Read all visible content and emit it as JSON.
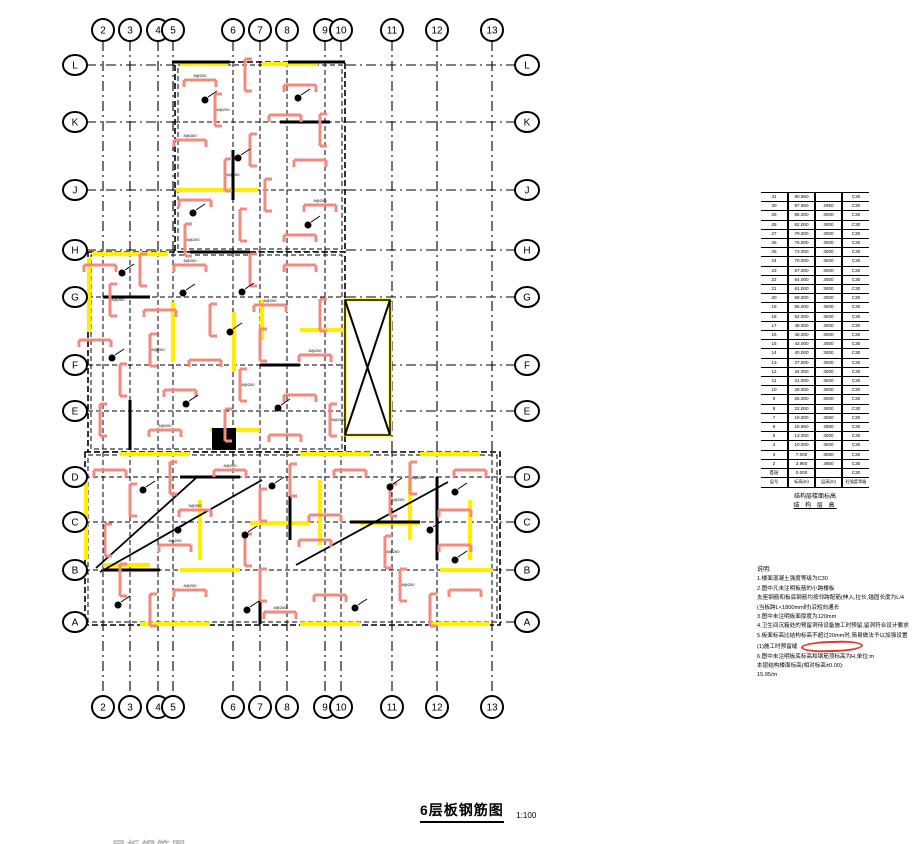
{
  "drawing_title": {
    "text": "6层板钢筋图",
    "scale": "1:100"
  },
  "clipped_next_title": "层板钢筋图",
  "colors": {
    "line": "#000000",
    "rebar": "#f28a80",
    "highlight": "#ffee00",
    "red_mark": "#e23b2e",
    "faint": "#b5b5b5"
  },
  "grid": {
    "cols": [
      {
        "label": "2",
        "x": 103
      },
      {
        "label": "3",
        "x": 130
      },
      {
        "label": "4",
        "x": 158
      },
      {
        "label": "5",
        "x": 173
      },
      {
        "label": "6",
        "x": 233
      },
      {
        "label": "7",
        "x": 260
      },
      {
        "label": "8",
        "x": 287
      },
      {
        "label": "9",
        "x": 325
      },
      {
        "label": "10",
        "x": 341
      },
      {
        "label": "11",
        "x": 392
      },
      {
        "label": "12",
        "x": 437
      },
      {
        "label": "13",
        "x": 492
      }
    ],
    "rows": [
      {
        "label": "L",
        "y": 65
      },
      {
        "label": "K",
        "y": 122
      },
      {
        "label": "J",
        "y": 190
      },
      {
        "label": "H",
        "y": 250
      },
      {
        "label": "G",
        "y": 297
      },
      {
        "label": "F",
        "y": 365
      },
      {
        "label": "E",
        "y": 411
      },
      {
        "label": "D",
        "y": 477
      },
      {
        "label": "C",
        "y": 522
      },
      {
        "label": "B",
        "y": 570
      },
      {
        "label": "A",
        "y": 622
      }
    ],
    "top_bubble_y": 30,
    "bottom_bubble_y": 707,
    "left_bubble_x": 75,
    "right_bubble_x": 527,
    "v_line_y1": 41,
    "v_line_y2": 696,
    "h_line_x1": 86,
    "h_line_x2": 516
  },
  "plan": {
    "blocks": [
      [
        175,
        62,
        345,
        252
      ],
      [
        88,
        252,
        345,
        452
      ],
      [
        85,
        452,
        500,
        625
      ]
    ],
    "void_box": [
      345,
      300,
      390,
      435
    ],
    "solid_block": [
      212,
      428,
      24,
      22
    ],
    "diagonals": [
      [
        100,
        572,
        262,
        480
      ],
      [
        96,
        568,
        196,
        478
      ],
      [
        296,
        565,
        448,
        482
      ]
    ],
    "walls": [
      [
        190,
        252,
        250,
        252
      ],
      [
        280,
        122,
        330,
        122
      ],
      [
        233,
        150,
        233,
        200
      ],
      [
        103,
        297,
        150,
        297
      ],
      [
        260,
        365,
        300,
        365
      ],
      [
        130,
        400,
        130,
        450
      ],
      [
        180,
        477,
        240,
        477
      ],
      [
        350,
        522,
        420,
        522
      ],
      [
        103,
        570,
        160,
        570
      ],
      [
        290,
        477,
        290,
        540
      ],
      [
        437,
        477,
        437,
        560
      ],
      [
        260,
        570,
        260,
        624
      ],
      [
        172,
        62,
        230,
        62
      ],
      [
        288,
        62,
        345,
        62
      ]
    ],
    "yellow_segments": [
      [
        180,
        64,
        228,
        64
      ],
      [
        262,
        64,
        318,
        64
      ],
      [
        92,
        254,
        168,
        254
      ],
      [
        176,
        190,
        258,
        190
      ],
      [
        89,
        258,
        89,
        332
      ],
      [
        173,
        302,
        173,
        362
      ],
      [
        234,
        312,
        234,
        372
      ],
      [
        262,
        300,
        262,
        340
      ],
      [
        300,
        330,
        345,
        330
      ],
      [
        347,
        302,
        389,
        302
      ],
      [
        347,
        434,
        389,
        434
      ],
      [
        346,
        302,
        346,
        434
      ],
      [
        390,
        302,
        390,
        434
      ],
      [
        120,
        454,
        190,
        454
      ],
      [
        300,
        454,
        370,
        454
      ],
      [
        420,
        454,
        480,
        454
      ],
      [
        86,
        480,
        86,
        560
      ],
      [
        200,
        500,
        200,
        560
      ],
      [
        320,
        480,
        320,
        545
      ],
      [
        410,
        478,
        410,
        540
      ],
      [
        470,
        500,
        470,
        560
      ],
      [
        140,
        624,
        210,
        624
      ],
      [
        300,
        624,
        360,
        624
      ],
      [
        430,
        624,
        490,
        624
      ],
      [
        103,
        565,
        150,
        565
      ],
      [
        250,
        523,
        310,
        523
      ],
      [
        360,
        523,
        420,
        523
      ],
      [
        180,
        570,
        240,
        570
      ],
      [
        440,
        570,
        492,
        570
      ],
      [
        210,
        430,
        260,
        430
      ]
    ],
    "rebar_marks": [
      [
        200,
        80,
        "h"
      ],
      [
        245,
        75,
        "v"
      ],
      [
        300,
        85,
        "h"
      ],
      [
        215,
        110,
        "v"
      ],
      [
        285,
        115,
        "h"
      ],
      [
        320,
        130,
        "v"
      ],
      [
        190,
        140,
        "h"
      ],
      [
        250,
        150,
        "v"
      ],
      [
        310,
        160,
        "h"
      ],
      [
        225,
        175,
        "v"
      ],
      [
        195,
        200,
        "h"
      ],
      [
        265,
        195,
        "v"
      ],
      [
        320,
        205,
        "h"
      ],
      [
        240,
        225,
        "v"
      ],
      [
        300,
        235,
        "h"
      ],
      [
        185,
        240,
        "v"
      ],
      [
        100,
        265,
        "h"
      ],
      [
        140,
        270,
        "v"
      ],
      [
        190,
        265,
        "h"
      ],
      [
        250,
        270,
        "v"
      ],
      [
        300,
        265,
        "h"
      ],
      [
        110,
        300,
        "v"
      ],
      [
        160,
        310,
        "h"
      ],
      [
        210,
        320,
        "v"
      ],
      [
        270,
        305,
        "h"
      ],
      [
        320,
        315,
        "v"
      ],
      [
        95,
        340,
        "h"
      ],
      [
        150,
        350,
        "v"
      ],
      [
        205,
        360,
        "h"
      ],
      [
        260,
        345,
        "v"
      ],
      [
        315,
        355,
        "h"
      ],
      [
        120,
        380,
        "v"
      ],
      [
        180,
        390,
        "h"
      ],
      [
        240,
        385,
        "v"
      ],
      [
        300,
        395,
        "h"
      ],
      [
        100,
        420,
        "v"
      ],
      [
        165,
        430,
        "h"
      ],
      [
        225,
        425,
        "v"
      ],
      [
        285,
        435,
        "h"
      ],
      [
        330,
        420,
        "v"
      ],
      [
        110,
        470,
        "h"
      ],
      [
        170,
        478,
        "v"
      ],
      [
        230,
        470,
        "h"
      ],
      [
        290,
        480,
        "v"
      ],
      [
        350,
        470,
        "h"
      ],
      [
        410,
        478,
        "v"
      ],
      [
        470,
        470,
        "h"
      ],
      [
        130,
        500,
        "v"
      ],
      [
        195,
        510,
        "h"
      ],
      [
        260,
        505,
        "v"
      ],
      [
        325,
        515,
        "h"
      ],
      [
        390,
        500,
        "v"
      ],
      [
        455,
        510,
        "h"
      ],
      [
        105,
        540,
        "v"
      ],
      [
        175,
        545,
        "h"
      ],
      [
        245,
        550,
        "v"
      ],
      [
        315,
        540,
        "h"
      ],
      [
        385,
        552,
        "v"
      ],
      [
        455,
        545,
        "h"
      ],
      [
        120,
        580,
        "v"
      ],
      [
        190,
        590,
        "h"
      ],
      [
        260,
        585,
        "v"
      ],
      [
        330,
        595,
        "h"
      ],
      [
        400,
        585,
        "v"
      ],
      [
        465,
        590,
        "h"
      ],
      [
        150,
        610,
        "v"
      ],
      [
        280,
        612,
        "h"
      ],
      [
        430,
        610,
        "v"
      ]
    ],
    "rebar_label": "8@200",
    "dots": [
      [
        205,
        100
      ],
      [
        298,
        98
      ],
      [
        238,
        158
      ],
      [
        193,
        213
      ],
      [
        308,
        225
      ],
      [
        122,
        273
      ],
      [
        183,
        293
      ],
      [
        242,
        292
      ],
      [
        112,
        358
      ],
      [
        230,
        332
      ],
      [
        186,
        404
      ],
      [
        278,
        408
      ],
      [
        143,
        490
      ],
      [
        272,
        486
      ],
      [
        390,
        487
      ],
      [
        455,
        492
      ],
      [
        178,
        530
      ],
      [
        245,
        535
      ],
      [
        430,
        530
      ],
      [
        118,
        605
      ],
      [
        247,
        610
      ],
      [
        355,
        608
      ],
      [
        455,
        560
      ]
    ]
  },
  "elevation_table": {
    "columns": [
      "层号",
      "标高(m)",
      "层高(m)",
      "砼强度等级"
    ],
    "rows": [
      [
        "31",
        "90.950",
        "",
        "C30"
      ],
      [
        "30",
        "87.950",
        "2950",
        "C30"
      ],
      [
        "29",
        "85.000",
        "3000",
        "C30"
      ],
      [
        "28",
        "82.000",
        "3000",
        "C30"
      ],
      [
        "27",
        "79.000",
        "3000",
        "C30"
      ],
      [
        "26",
        "76.000",
        "3000",
        "C30"
      ],
      [
        "25",
        "73.000",
        "3000",
        "C30"
      ],
      [
        "24",
        "70.000",
        "3000",
        "C30"
      ],
      [
        "23",
        "67.000",
        "3000",
        "C30"
      ],
      [
        "22",
        "64.000",
        "3000",
        "C30"
      ],
      [
        "21",
        "61.000",
        "3000",
        "C30"
      ],
      [
        "20",
        "58.000",
        "3000",
        "C30"
      ],
      [
        "19",
        "55.000",
        "3000",
        "C30"
      ],
      [
        "18",
        "52.000",
        "3000",
        "C30"
      ],
      [
        "17",
        "49.000",
        "3000",
        "C30"
      ],
      [
        "16",
        "46.000",
        "3000",
        "C30"
      ],
      [
        "15",
        "43.000",
        "3000",
        "C30"
      ],
      [
        "14",
        "40.000",
        "3000",
        "C30"
      ],
      [
        "13",
        "37.000",
        "3000",
        "C30"
      ],
      [
        "12",
        "34.000",
        "3000",
        "C30"
      ],
      [
        "11",
        "31.000",
        "3000",
        "C30"
      ],
      [
        "10",
        "28.000",
        "3000",
        "C30"
      ],
      [
        "9",
        "25.000",
        "3000",
        "C30"
      ],
      [
        "8",
        "22.000",
        "3000",
        "C30"
      ],
      [
        "7",
        "19.000",
        "3050",
        "C30"
      ],
      [
        "6",
        "15.950",
        "2950",
        "C30"
      ],
      [
        "5",
        "13.000",
        "3000",
        "C30"
      ],
      [
        "4",
        "10.000",
        "3000",
        "C30"
      ],
      [
        "3",
        "7.000",
        "3050",
        "C30"
      ],
      [
        "2",
        "3.950",
        "3950",
        "C30"
      ],
      [
        "首层",
        "0.000",
        "",
        "C30"
      ]
    ],
    "caption_line1": "结构层楼面标高",
    "caption_line2": "结 构 层 高"
  },
  "notes": {
    "title": "说明:",
    "lines": [
      "1.楼面混凝土强度等级为C30",
      "2.图中凡未注明板筋的小跨楼板",
      "  支座钢筋和板底钢筋均按邻跨配筋(伸入,拉长,锚固长度为L/4",
      "  (当板跨L<1800mm时)沿短向通长",
      "3.图中未注明板面厚度为120mm",
      "4.卫生间沉箱处的预留洞待设备施工时预留,留洞符合设计要求",
      "5.板面标高比结构标高不超过20mm时,简易做法予以加强设置",
      "  (1)施工时预留缝",
      "6.图中未注明板底标高和钢筋顶标高为H,单位:m",
      "  本层结构楼面标高(相对标高±0.00):",
      "  15.95/m"
    ],
    "red_mark_after_line": 7
  }
}
